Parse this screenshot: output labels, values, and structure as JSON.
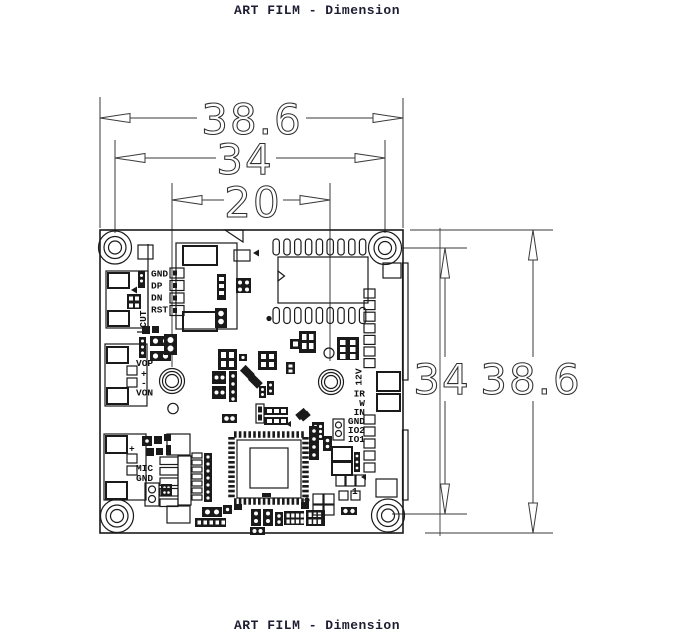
{
  "title_top": "ART FILM - Dimension",
  "title_bottom": "ART FILM - Dimension",
  "dimensions": {
    "board_width": "38.6",
    "hole_spacing_h": "34",
    "lens_spacing": "20",
    "hole_spacing_v": "34",
    "board_height": "38.6"
  },
  "labels": {
    "usb_pads": [
      "GND",
      "DP",
      "DN",
      "RST"
    ],
    "cut": "CUT",
    "video_out": [
      "VOP",
      "+",
      "-",
      "VON"
    ],
    "power": "12V",
    "io_pads": [
      "IR",
      "W",
      "IN",
      "GND",
      "IO2",
      "IO1"
    ],
    "audio": [
      "+",
      "MIC",
      "GND"
    ],
    "pin_one": "1"
  },
  "colors": {
    "background": "#ffffff",
    "board_line": "#1a1a1a",
    "dimension_line": "#3a3a3a",
    "label_text": "#111111",
    "title_text": "#1e1e32"
  }
}
